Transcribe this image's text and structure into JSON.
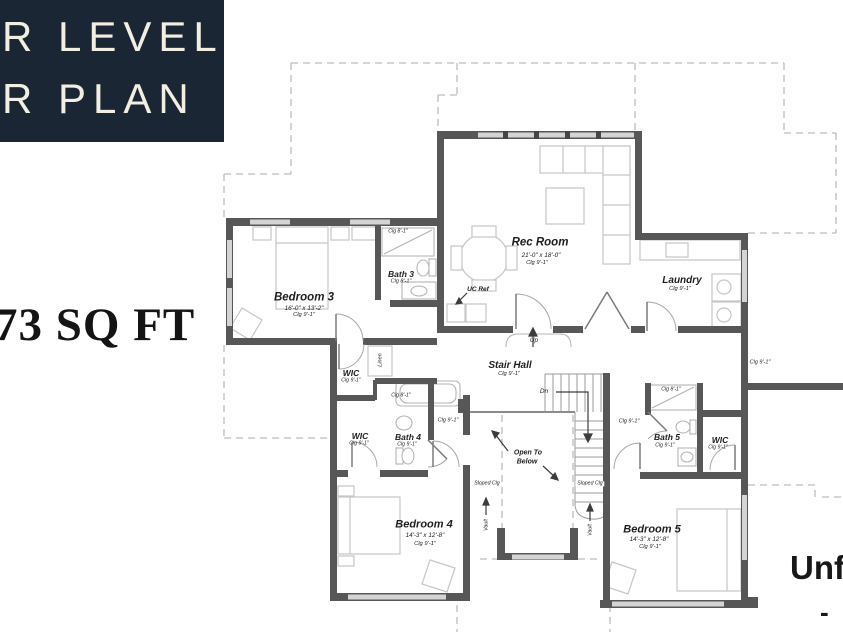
{
  "header": {
    "line1": "R LEVEL",
    "line2": "R PLAN"
  },
  "area_text": "73 SQ FT",
  "unfinished": {
    "line1": "Unfi",
    "line2": "-"
  },
  "rooms": {
    "rec_room": {
      "name": "Rec Room",
      "dims": "21'-0\" x 18'-0\"",
      "clg": "Clg 9'-1\""
    },
    "laundry": {
      "name": "Laundry",
      "clg": "Clg 9'-1\""
    },
    "bedroom3": {
      "name": "Bedroom 3",
      "dims": "16'-0\" x 13'-2\"",
      "clg": "Clg 9'-1\""
    },
    "bath3": {
      "name": "Bath 3",
      "clg": "Clg 8'-1\""
    },
    "stair_hall": {
      "name": "Stair Hall",
      "clg": "Clg 9'-1\""
    },
    "wic_upper": {
      "name": "WIC",
      "clg": "Clg 9'-1\""
    },
    "wic_lower": {
      "name": "WIC",
      "clg": "Clg 9'-1\""
    },
    "bath4": {
      "name": "Bath 4",
      "clg": "Clg 9'-1\""
    },
    "bedroom4": {
      "name": "Bedroom 4",
      "dims": "14'-3\" x 12'-8\"",
      "clg": "Clg 9'-1\""
    },
    "bedroom5": {
      "name": "Bedroom 5",
      "dims": "14'-3\" x 12'-8\"",
      "clg": "Clg 9'-1\""
    },
    "bath5": {
      "name": "Bath 5",
      "clg": "Clg 9'-1\""
    },
    "wic_right": {
      "name": "WIC",
      "clg": "Clg 9'-1\""
    }
  },
  "annotations": {
    "up": "Up",
    "dn": "Dn",
    "open_line1": "Open To",
    "open_line2": "Below",
    "uc_ref": "UC Ref",
    "linen": "Linen",
    "vault": "Vault",
    "sloped_clg": "Sloped Clg",
    "clg8": "Clg 8'-1\"",
    "clg9": "Clg 9'-1\""
  },
  "colors": {
    "header_bg": "#1a2634",
    "header_text": "#f2eee2",
    "wall": "#575757",
    "window": "#d4d4d4",
    "furniture": "#c6c6c6",
    "roof_dash": "#bdbdbd",
    "label_text": "#1e1e1e"
  }
}
